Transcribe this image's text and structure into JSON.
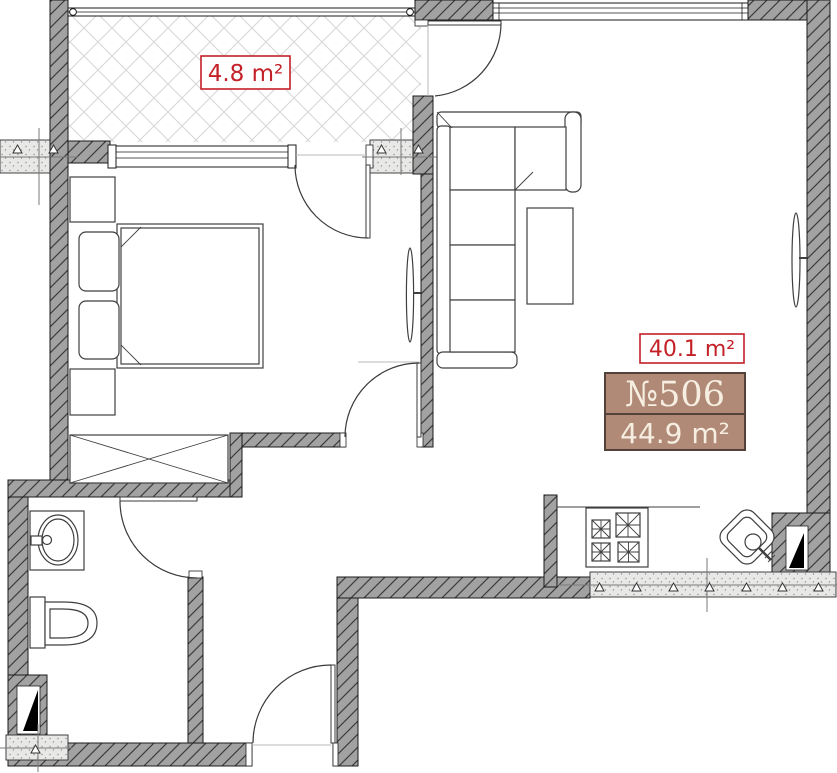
{
  "floor_plan": {
    "title": "apartment-floor-plan",
    "labels": {
      "balcony_area": "4.8 m²",
      "living_area": "40.1 m²",
      "apartment_number": "№506",
      "total_area": "44.9 m²"
    },
    "colors": {
      "area_label_red": "#c32127",
      "badge_background": "#b18977",
      "badge_border": "#53423a",
      "badge_text": "#f6efe1",
      "wall_fill": "#a2a2a2",
      "wall_hatch": "#3c3c3c",
      "pier_fill": "#e8e8e6",
      "balcony_hatch": "#d6d6d6"
    },
    "fixtures": [
      "balcony-glazing",
      "window",
      "balcony-door",
      "bedroom-door",
      "bathroom-door",
      "entrance-door",
      "double-bed",
      "nightstand",
      "wardrobe",
      "corner-sofa",
      "coffee-table",
      "radiator",
      "washbasin",
      "toilet",
      "cooktop",
      "kitchen-sink",
      "vent-shaft",
      "structural-pier"
    ]
  }
}
